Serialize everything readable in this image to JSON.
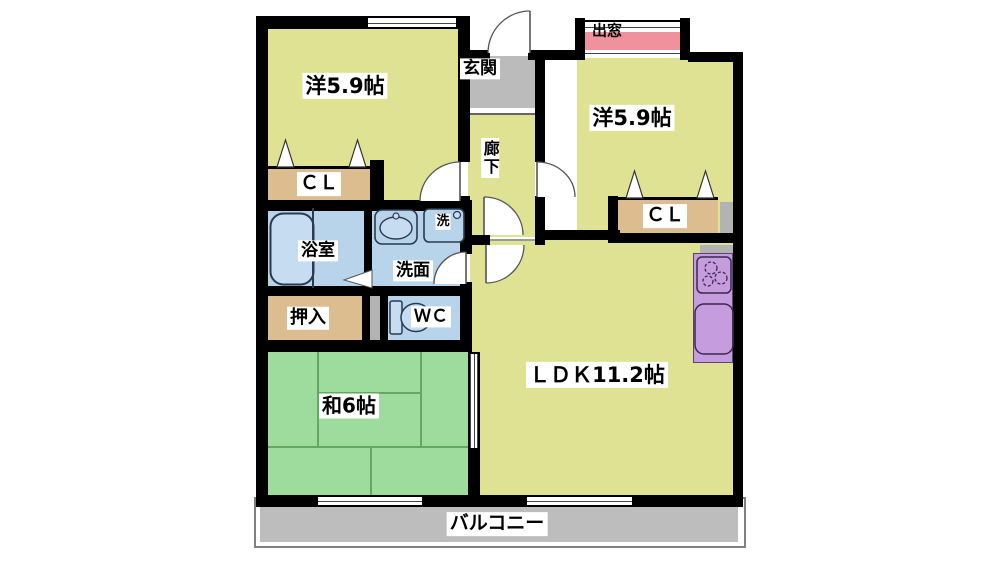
{
  "floorplan": {
    "rooms": {
      "western_room_1": "洋5.9帖",
      "western_room_2": "洋5.9帖",
      "entrance": "玄関",
      "hallway": "廊下",
      "bay_window": "出窓",
      "closet_1": "ＣＬ",
      "closet_2": "ＣＬ",
      "bathroom": "浴室",
      "washroom": "洗面",
      "washer": "洗",
      "futon_closet": "押入",
      "toilet": "ＷＣ",
      "japanese_room": "和6帖",
      "ldk": "ＬＤＫ11.2帖",
      "balcony": "バルコニー"
    },
    "fixtures": [
      "bathtub-icon",
      "washbasin-icon",
      "washing-machine-icon",
      "toilet-icon",
      "stove-icon",
      "kitchen-sink-icon",
      "door-swing-icon",
      "folding-door-icon",
      "sliding-window-icon"
    ],
    "colors": {
      "room_yellow": "#dfe293",
      "tatami_green": "#9edc9e",
      "wet_area_blue": "#b7d4ea",
      "closet_tan": "#dcbd90",
      "bay_window_pink": "#f0929e",
      "kitchen_purple": "#c59ddf",
      "entrance_gray": "#bbbbbb",
      "balcony_gray": "#bdbdbd",
      "wall_black": "#000000"
    }
  }
}
